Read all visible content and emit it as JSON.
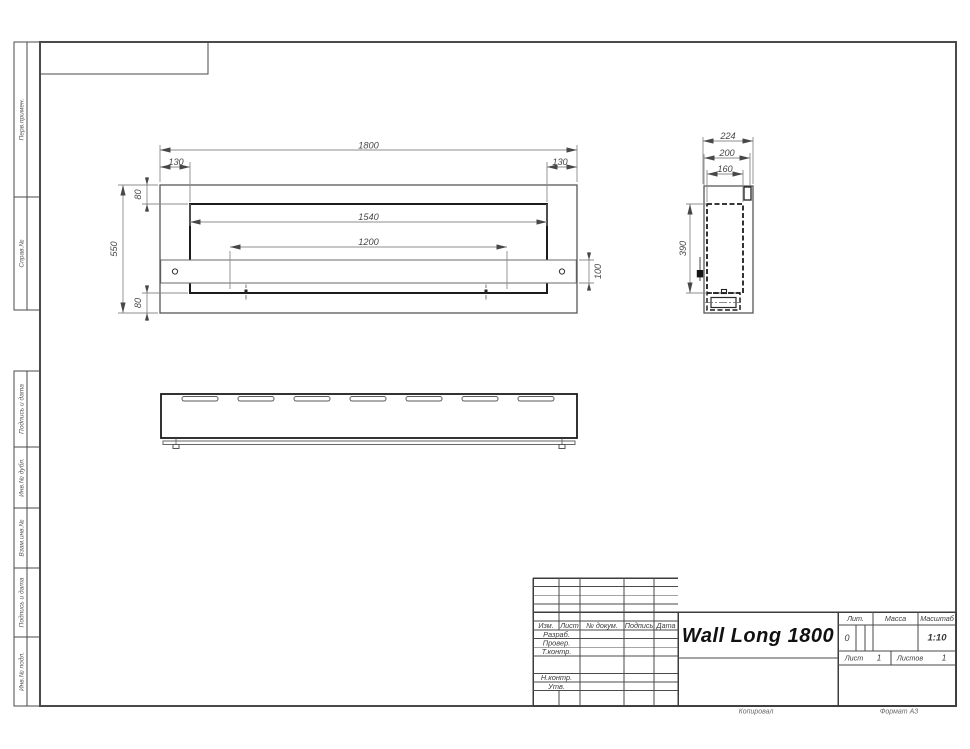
{
  "margin": {
    "top_labels": [
      "Перв.примен.",
      "Справ.№"
    ],
    "bottom_labels": [
      "Подпись и дата",
      "Инв.№ дубл.",
      "Взам.инв.№",
      "Подпись и дата",
      "Инв.№ подл."
    ]
  },
  "dims": {
    "front": {
      "width": "1800",
      "offset_left": "130",
      "offset_right": "130",
      "inset_top": "80",
      "height": "550",
      "opening_width": "1540",
      "mount_width": "1200",
      "bracket_height": "100",
      "inset_bottom": "80"
    },
    "side": {
      "depth": "224",
      "bracket_depth": "200",
      "inner_depth": "160",
      "opening_height": "390"
    }
  },
  "title_block": {
    "title": "Wall Long 1800",
    "header_cols": [
      "Изм.",
      "Лист",
      "№ докум.",
      "Подпись",
      "Дата"
    ],
    "roles": [
      "Разраб.",
      "Провер.",
      "Т.контр.",
      "Н.контр.",
      "Утв."
    ],
    "lit_label": "Лит.",
    "lit_value": "0",
    "mass_label": "Масса",
    "scale_label": "Масштаб",
    "scale_value": "1:10",
    "sheet_label": "Лист",
    "sheet_number": "1",
    "sheets_label": "Листов",
    "sheets_total": "1"
  },
  "footer": {
    "copied": "Копировал",
    "format": "Формат А3"
  }
}
